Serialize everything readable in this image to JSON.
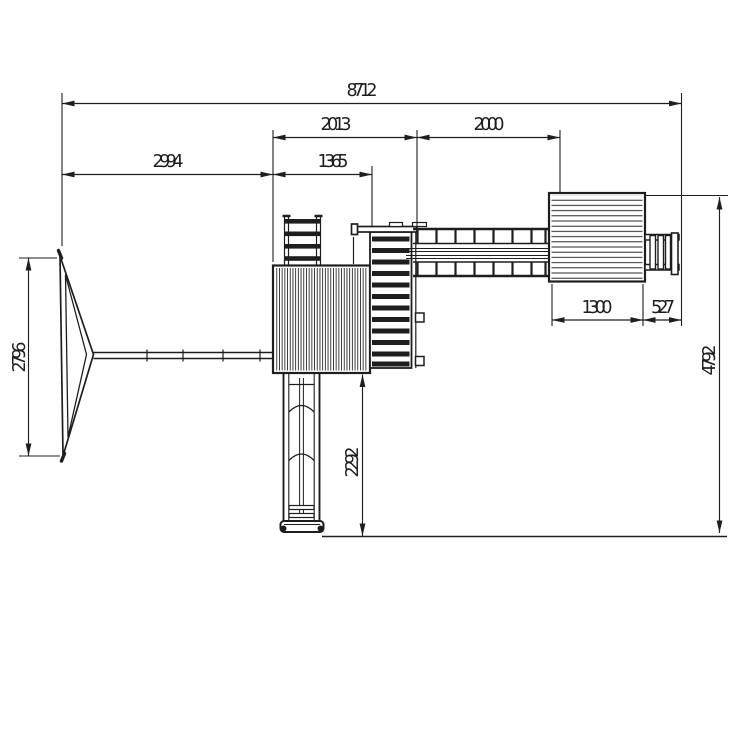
{
  "drawing": {
    "type": "technical dimension drawing",
    "subject": "wooden playground set - top view plan",
    "units": "mm",
    "line_color": "#1e1e1e",
    "background_color": "#ffffff",
    "dimensions": {
      "overall_width": "8712",
      "tower_stairs_span": "2013",
      "bridge_span": "2000",
      "swing_beam_span": "2994",
      "main_platform_width": "1365",
      "playhouse_width": "1300",
      "side_ladder_width": "527",
      "swing_frame_depth": "2796",
      "overall_depth": "4792",
      "slide_length": "2292"
    }
  }
}
